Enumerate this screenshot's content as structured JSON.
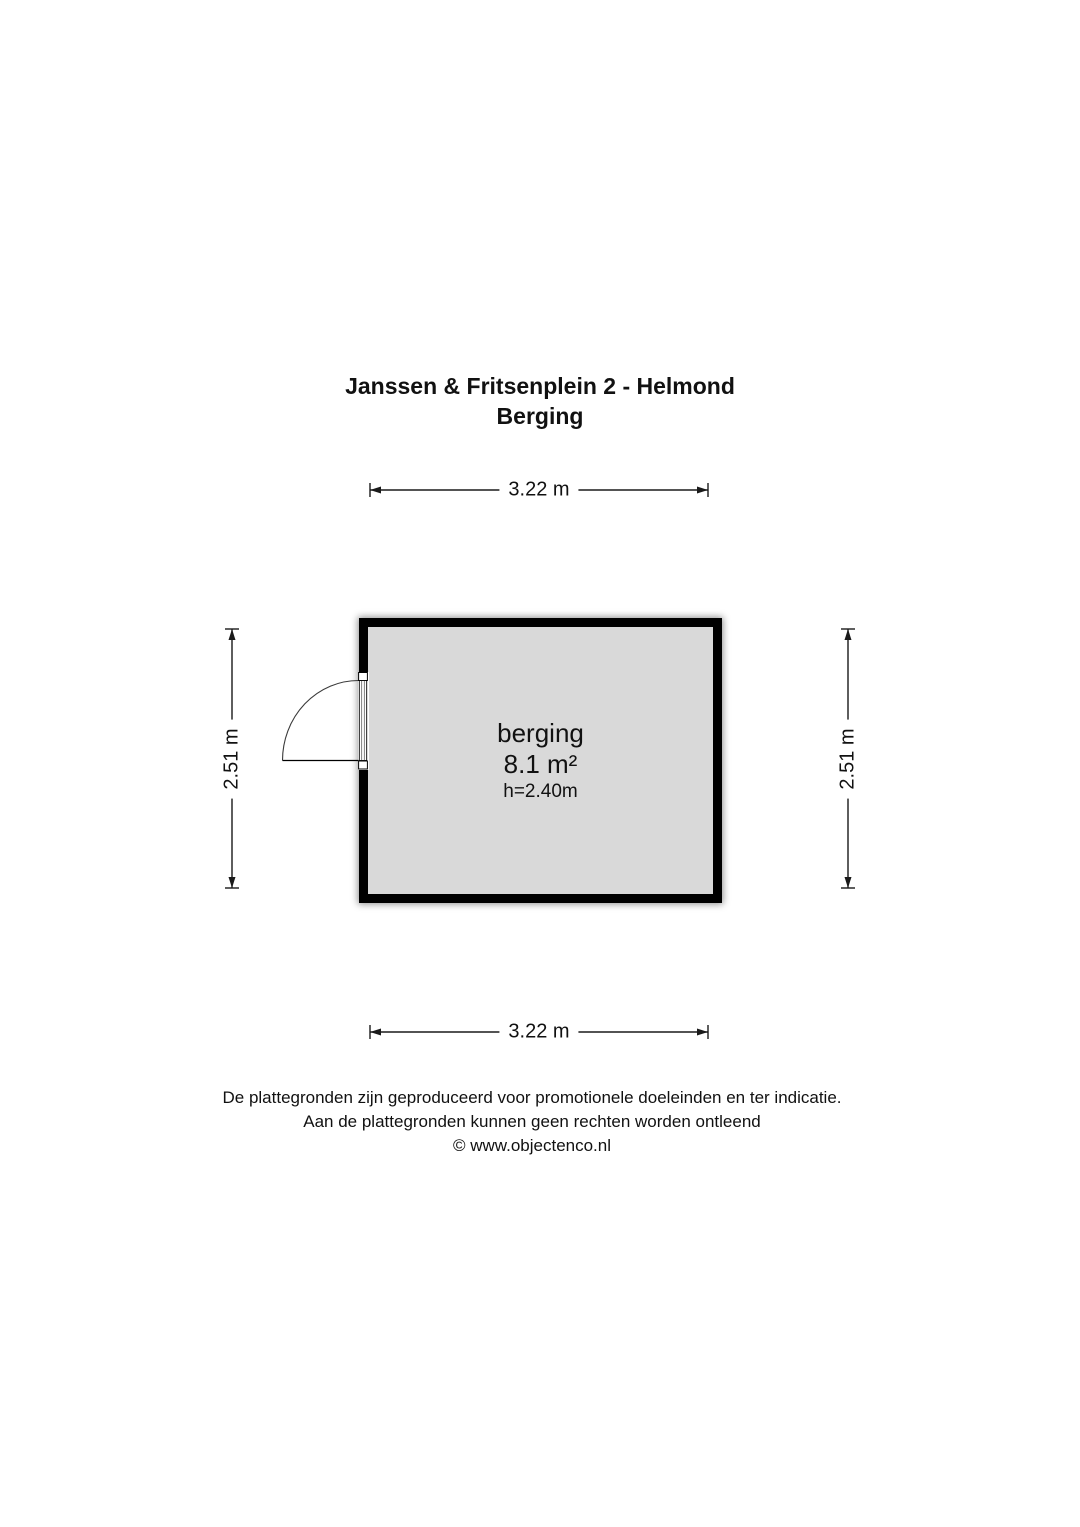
{
  "title": {
    "line1": "Janssen & Fritsenplein 2 - Helmond",
    "line2": "Berging"
  },
  "dimensions": {
    "top": {
      "label": "3.22 m"
    },
    "bottom": {
      "label": "3.22 m"
    },
    "left": {
      "label": "2.51 m"
    },
    "right": {
      "label": "2.51 m"
    }
  },
  "room": {
    "name": "berging",
    "area": "8.1 m²",
    "ceiling_height": "h=2.40m"
  },
  "footer": {
    "line1": "De plattegronden zijn geproduceerd voor promotionele doeleinden en ter indicatie.",
    "line2": "Aan de plattegronden kunnen geen rechten worden ontleend",
    "line3": "© www.objectenco.nl"
  },
  "colors": {
    "wall": "#000000",
    "floor": "#d9d9d9",
    "line": "#1a1a1a",
    "text": "#111111",
    "background": "#ffffff"
  }
}
